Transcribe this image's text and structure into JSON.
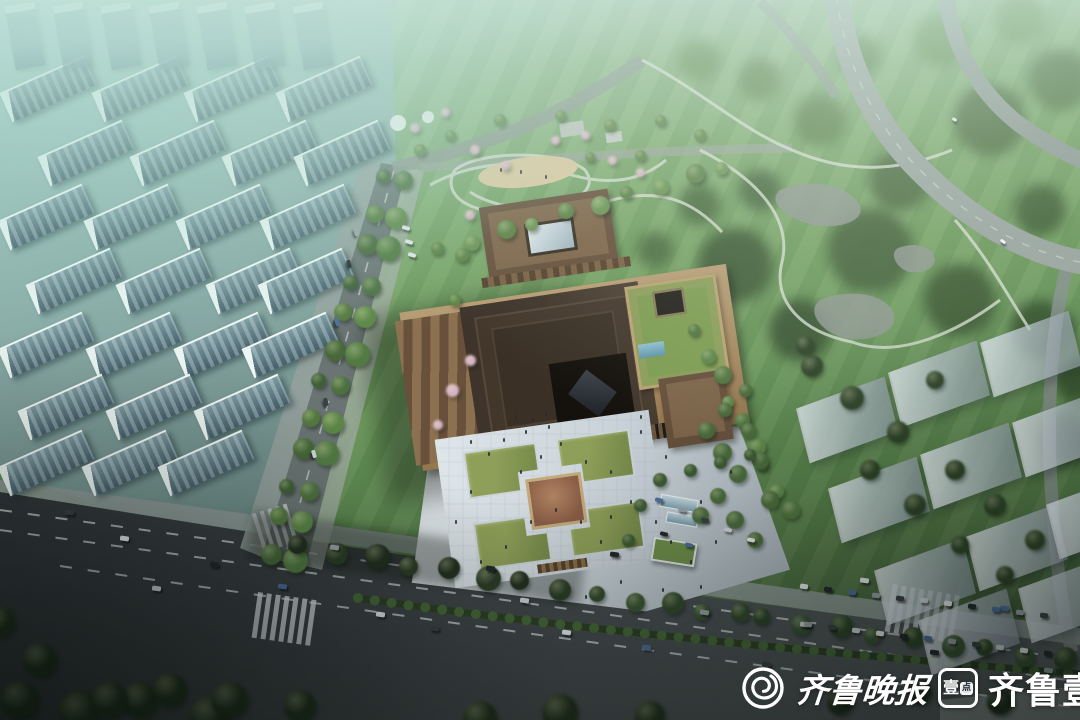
{
  "scene": {
    "description": "aerial-rendering-of-museum-campus",
    "watermark": {
      "paper_name": "齐鲁晚报",
      "app_name": "齐鲁壹点",
      "app_icon_char": "壹",
      "app_icon_dot": "点"
    },
    "palette": {
      "haze_teal": "#aed6cd",
      "city_facade": "#5f7d87",
      "park_green": "#6f9257",
      "forest_green": "#3e5a3d",
      "museum_roof": "#3f342b",
      "museum_wall": "#7a5f45",
      "museum_terrace": "#b69c74",
      "plaza_paving": "#d3dce1",
      "lawn_green": "#7c9150",
      "medallion_brown": "#8a6049",
      "road_asphalt": "#42484a",
      "ghost_block": "#b9c3c9",
      "highway_gray": "#95a19d",
      "watermark_white": "#ffffff"
    }
  }
}
